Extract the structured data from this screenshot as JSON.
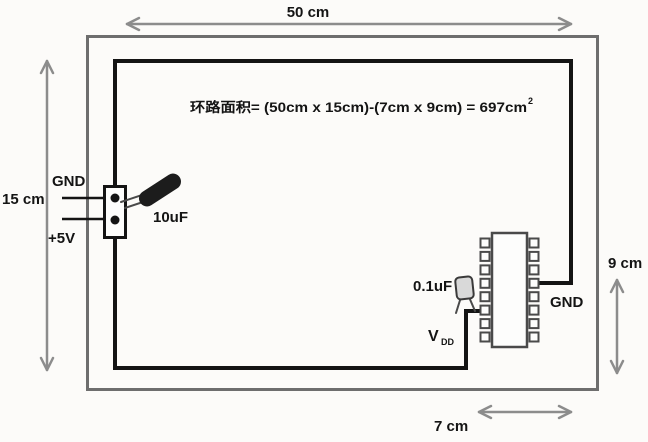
{
  "formula": {
    "text": "环路面积= (50cm x 15cm)-(7cm x 9cm) = 697cm",
    "superscript": "2"
  },
  "dimensions": {
    "top": "50 cm",
    "left": "15 cm",
    "right": "9 cm",
    "bottom": "7 cm"
  },
  "power_input": {
    "gnd_label": "GND",
    "plus5v_label": "+5V"
  },
  "components": {
    "bulk_capacitor_label": "10uF",
    "decoupling_capacitor_label": "0.1uF",
    "vdd_label": "V",
    "vdd_subscript": "DD",
    "ic_gnd_label": "GND"
  },
  "colors": {
    "background": "#fcfbf9",
    "board_outline": "#6e6e6e",
    "trace": "#141414",
    "dimension_arrow": "#8c8c8c",
    "text": "#141414",
    "bulk_capacitor_body": "#1c1c1c",
    "decoupling_capacitor_fill": "#d9d9d9",
    "ic_outline": "#4a4a4a",
    "ic_fill": "#fdfdfc"
  }
}
